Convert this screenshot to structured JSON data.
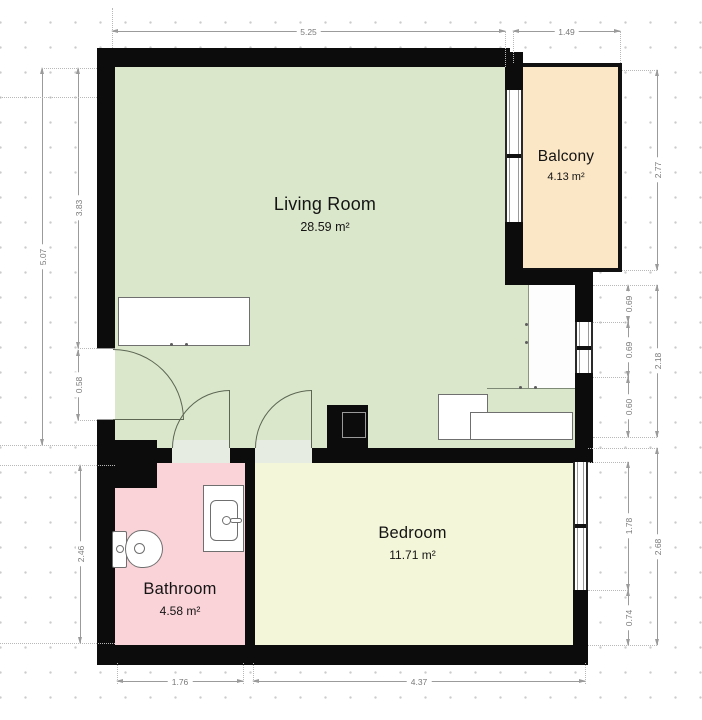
{
  "plan": {
    "rooms": {
      "living_room": {
        "label": "Living Room",
        "area": "28.59 m²"
      },
      "balcony": {
        "label": "Balcony",
        "area": "4.13 m²"
      },
      "bedroom": {
        "label": "Bedroom",
        "area": "11.71 m²"
      },
      "bathroom": {
        "label": "Bathroom",
        "area": "4.58 m²"
      }
    },
    "dimensions": {
      "top_living": "5.25",
      "top_balcony": "1.49",
      "left_total": "5.07",
      "left_upper": "3.83",
      "left_door": "0.58",
      "left_bathroom": "2.46",
      "right_balcony": "2.77",
      "right_upper_seg": "0.69",
      "right_window_mid": "0.69",
      "right_lower_seg": "0.60",
      "right_mid_total": "2.18",
      "right_bedroom_window": "1.78",
      "right_bedroom_wall": "0.74",
      "right_bedroom_total": "2.68",
      "bottom_bathroom": "1.76",
      "bottom_bedroom": "4.37"
    },
    "colors": {
      "wall": "#0c0c0c",
      "living_room_fill": "#dbe7cb",
      "balcony_fill": "#fbe7c6",
      "bedroom_fill": "#f4f6d9",
      "bathroom_fill": "#fad3d8",
      "dimension_line": "#9b9b9b"
    }
  }
}
